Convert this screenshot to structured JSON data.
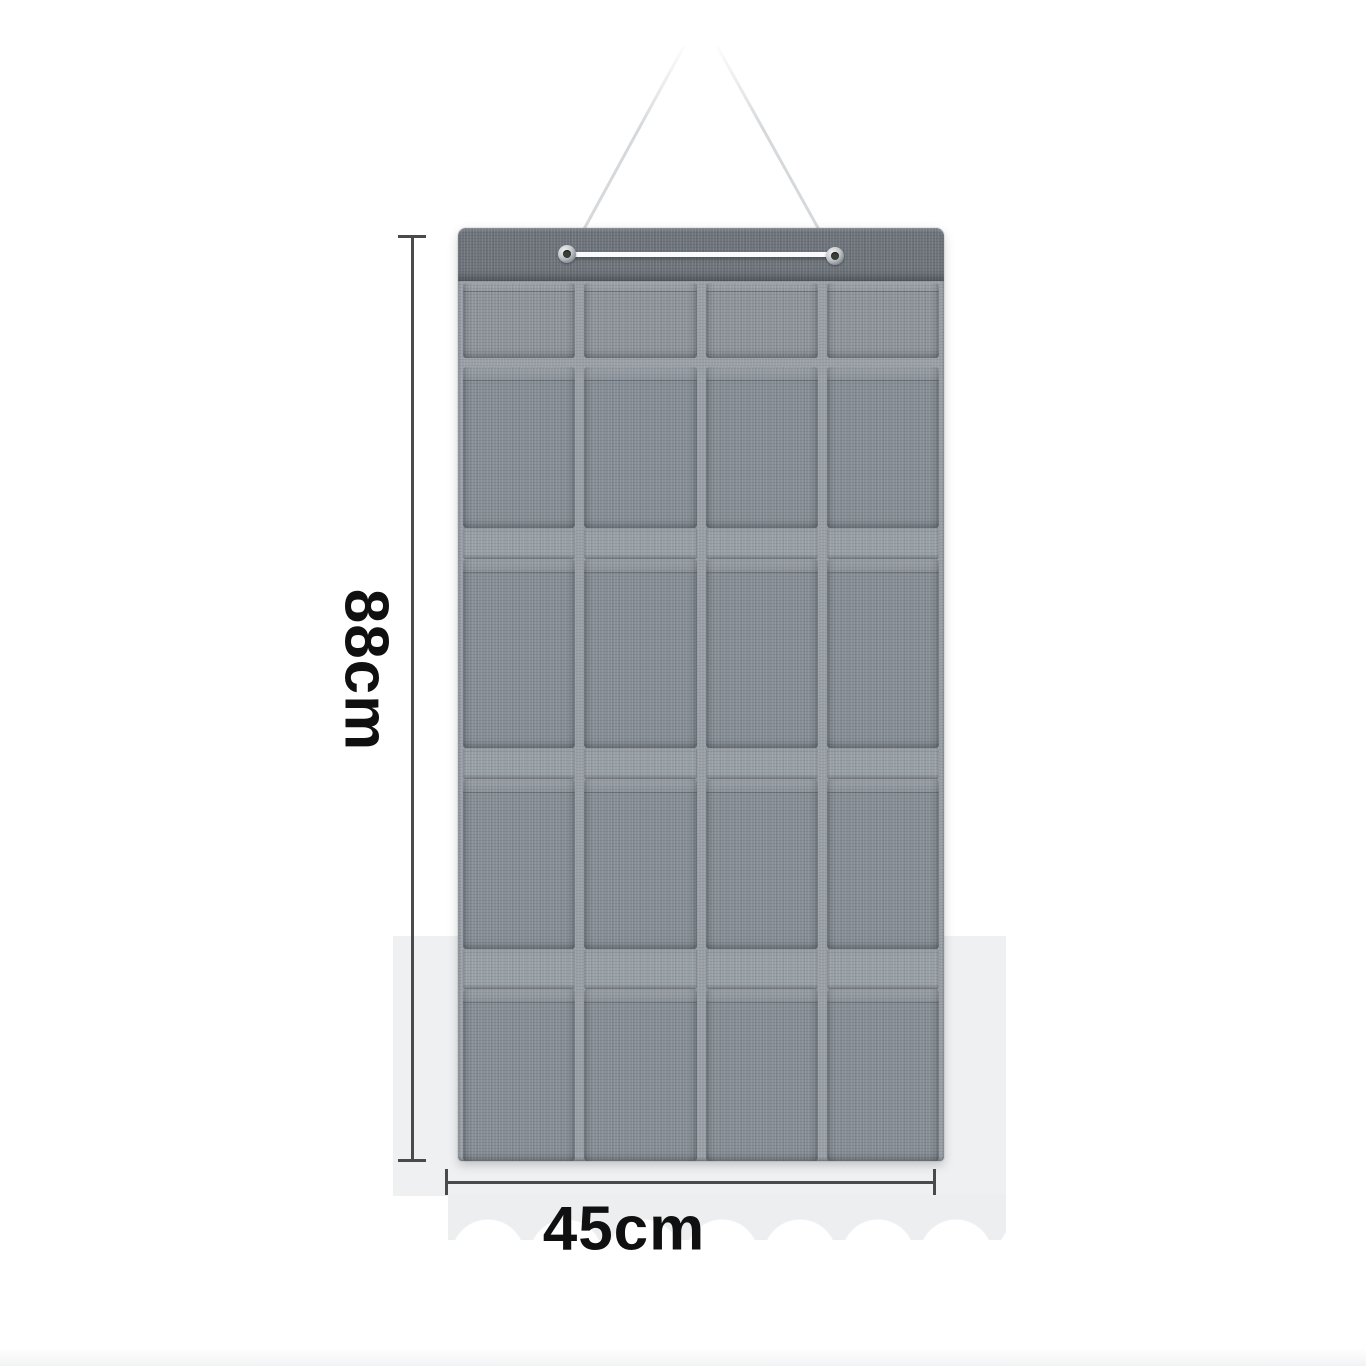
{
  "annotations": {
    "height_label": "88cm",
    "width_label": "45cm",
    "text_color": "#101010",
    "line_color": "#4a4a4a"
  },
  "organizer": {
    "columns": 4,
    "pocket_rows": 5,
    "total_pockets": 20,
    "grommets": 2,
    "colors": {
      "header": "#6f757c",
      "backing": "#9aa0a7",
      "pocket": "#878e96",
      "pocket_short": "#8f959c",
      "rail": "#99a0a7",
      "cord": "#f8fafb",
      "rope": "#d6d9dc",
      "grommet_ring": "#c2c6ca",
      "grommet_hole": "#3a3d36"
    }
  },
  "background": {
    "page": "#ffffff",
    "backdrop_band": "#eff0f2",
    "bottom_strip": "#f2f3f4"
  }
}
